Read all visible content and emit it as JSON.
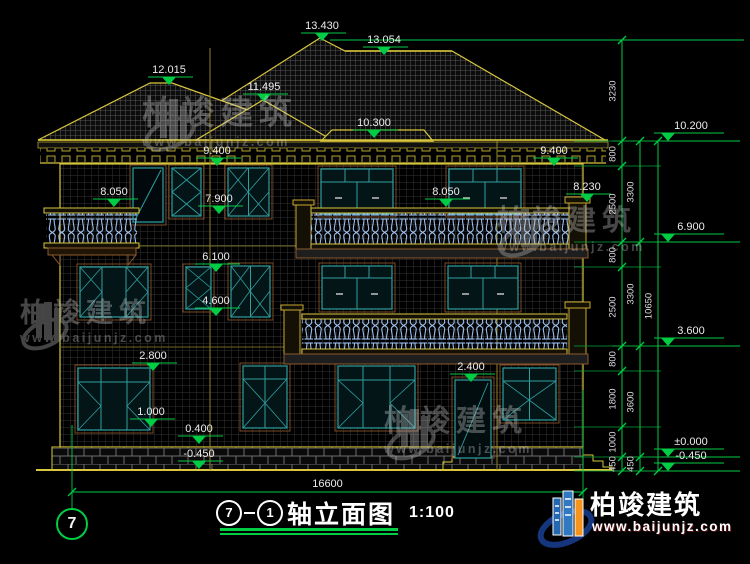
{
  "watermark": {
    "brand": "柏竣建筑",
    "url": "www.baijunjz.com"
  },
  "logo": {
    "brand": "柏竣建筑",
    "url": "www.baijunjz.com"
  },
  "title": {
    "axis_start": "7",
    "axis_end": "1",
    "text": "轴立面图",
    "scale": "1:100"
  },
  "axis_bubble": {
    "label": "7"
  },
  "dimensions": {
    "overall_width": {
      "label": "16600",
      "x1": 72,
      "x2": 583,
      "y": 492
    },
    "levels": [
      {
        "label": "13.430",
        "x": 322,
        "y": 41
      },
      {
        "label": "13.054",
        "x": 384,
        "y": 55
      },
      {
        "label": "12.015",
        "x": 169,
        "y": 85
      },
      {
        "label": "11.495",
        "x": 264,
        "y": 102
      },
      {
        "label": "10.300",
        "x": 374,
        "y": 138
      },
      {
        "label": "10.200",
        "x": 668,
        "y": 141,
        "right": true
      },
      {
        "label": "9.400",
        "x": 217,
        "y": 166
      },
      {
        "label": "9.400",
        "x": 554,
        "y": 166
      },
      {
        "label": "8.050",
        "x": 114,
        "y": 207
      },
      {
        "label": "8.050",
        "x": 446,
        "y": 207
      },
      {
        "label": "8.230",
        "x": 587,
        "y": 202
      },
      {
        "label": "7.900",
        "x": 219,
        "y": 214
      },
      {
        "label": "6.900",
        "x": 668,
        "y": 242,
        "right": true
      },
      {
        "label": "6.100",
        "x": 216,
        "y": 272
      },
      {
        "label": "4.600",
        "x": 216,
        "y": 316
      },
      {
        "label": "3.600",
        "x": 668,
        "y": 346,
        "right": true
      },
      {
        "label": "2.800",
        "x": 153,
        "y": 371
      },
      {
        "label": "2.400",
        "x": 471,
        "y": 382
      },
      {
        "label": "1.000",
        "x": 151,
        "y": 427
      },
      {
        "label": "0.400",
        "x": 199,
        "y": 444
      },
      {
        "label": "-0.450",
        "x": 199,
        "y": 469
      },
      {
        "label": "±0.000",
        "x": 668,
        "y": 457,
        "right": true
      },
      {
        "label": "-0.450",
        "x": 668,
        "y": 471,
        "right": true
      }
    ],
    "chains": [
      {
        "x": 622,
        "ticks": [
          40,
          141,
          166,
          242,
          267,
          346,
          371,
          427,
          457,
          471
        ],
        "labels": [
          "3230",
          "800",
          "2500",
          "800",
          "2500",
          "800",
          "1800",
          "1000",
          "450"
        ]
      },
      {
        "x": 640,
        "ticks": [
          141,
          242,
          346,
          457,
          471
        ],
        "labels": [
          "3300",
          "3300",
          "3600",
          "450"
        ]
      },
      {
        "x": 658,
        "ticks": [
          141,
          471
        ],
        "labels": [
          "10650"
        ]
      }
    ],
    "extension_ys": [
      141,
      166,
      242,
      267,
      346,
      371,
      427,
      457,
      471
    ]
  }
}
